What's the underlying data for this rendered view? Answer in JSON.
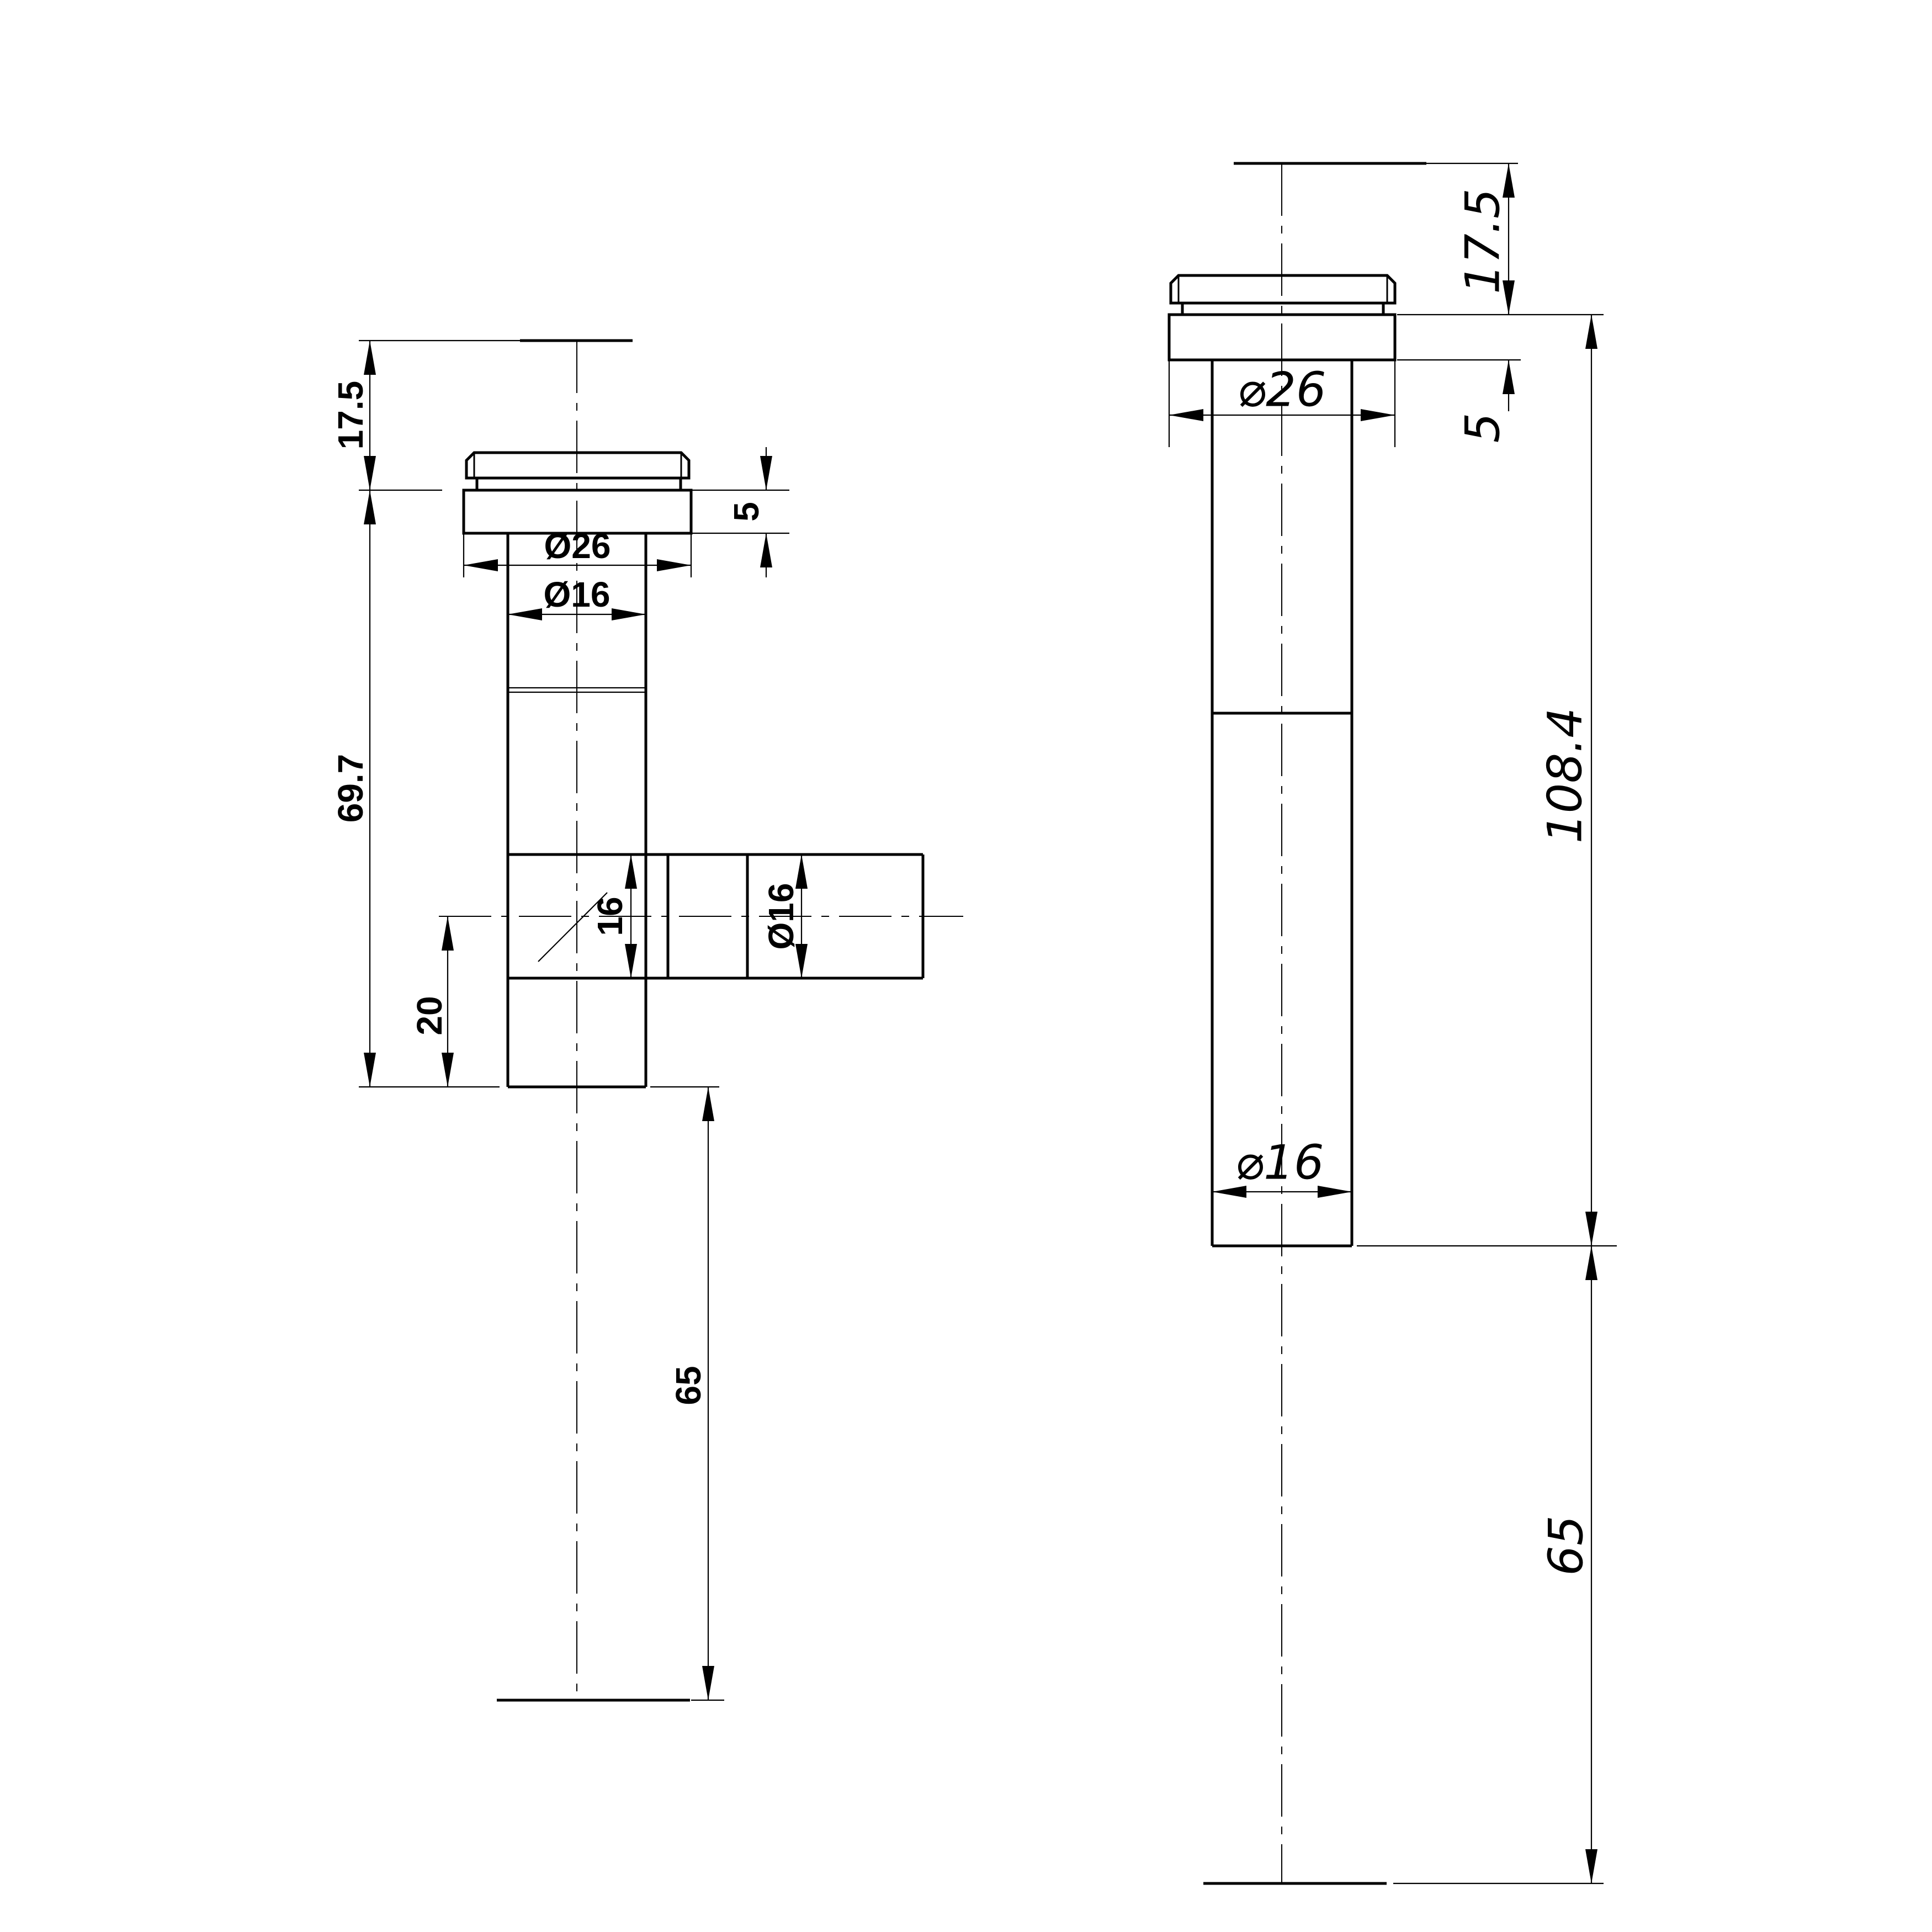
{
  "colors": {
    "background": "#ffffff",
    "line": "#000000"
  },
  "left_view": {
    "dim_17_5": "17.5",
    "dim_69_7": "69.7",
    "dim_20": "20",
    "dim_65": "65",
    "dim_dia26": "Ø26",
    "dim_dia16_shaft": "Ø16",
    "dim_16_tee": "16",
    "dim_dia16_branch": "Ø16",
    "dim_5": "5"
  },
  "right_view": {
    "dim_17_5": "17.5",
    "dim_5": "5",
    "dim_dia26": "⌀26",
    "dim_dia16": "⌀16",
    "dim_108_4": "108.4",
    "dim_65": "65"
  }
}
